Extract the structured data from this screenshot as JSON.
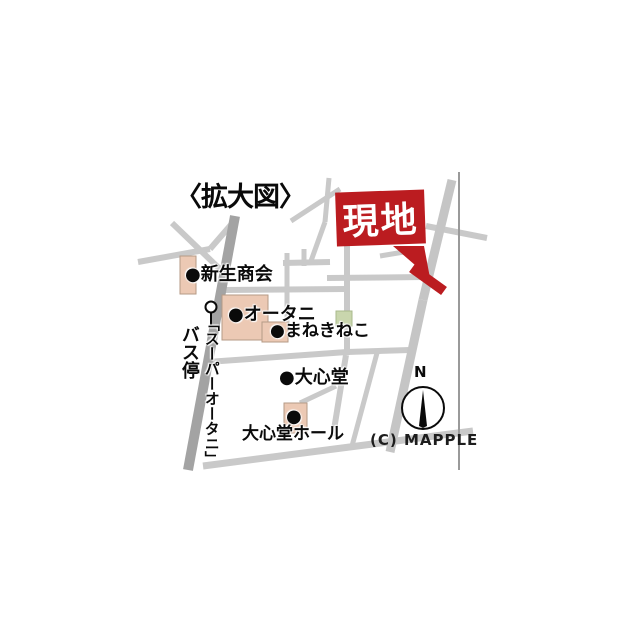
{
  "map": {
    "title": "〈拡大図〉",
    "site_marker": {
      "label": "現地"
    },
    "labels": [
      {
        "id": "shinsei-shokai",
        "text": "●新生商会"
      },
      {
        "id": "otani",
        "text": "●オータニ"
      },
      {
        "id": "manekineko",
        "text": "●まねきねこ"
      },
      {
        "id": "daishindo",
        "text": "●大心堂"
      },
      {
        "id": "daishindo-hall-bullet",
        "text": "●"
      },
      {
        "id": "daishindo-hall",
        "text": "大心堂ホール"
      },
      {
        "id": "bus-stop",
        "text": "バス停",
        "orientation": "vertical"
      },
      {
        "id": "super-otani",
        "text": "「スーパーオータニ」",
        "orientation": "vertical"
      }
    ],
    "compass": {
      "label": "N"
    },
    "credit": "(C) MAPPLE",
    "icons": {
      "bus_stop": "circle-on-pole",
      "compass": "north-needle-in-circle",
      "site_pointer": "red-callout-triangle"
    },
    "colors": {
      "site_red": "#bb1c20",
      "road_gray": "#c9c9c9",
      "road_dark_gray": "#a3a3a3",
      "building_tan": "#ecc9b4",
      "green_area": "#c9d6ad",
      "background": "#ffffff"
    }
  }
}
